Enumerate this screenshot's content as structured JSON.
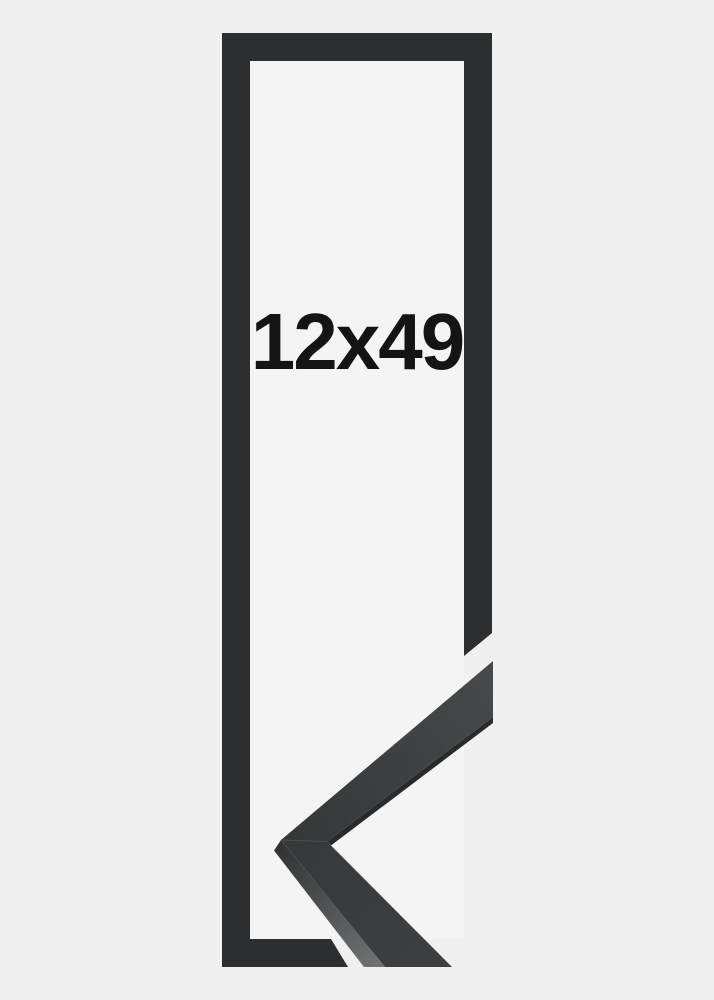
{
  "image": {
    "alt": "Tall narrow black picture frame shown as a flat outline with a 3D corner sample of the moulding profile at the lower right",
    "size_label": "12x49"
  },
  "colors": {
    "background": "#f0f0f1",
    "inner_background": "#f4f4f5",
    "frame": "#2c2e2f",
    "sample_face_start": "#343638",
    "sample_face_end": "#47494b",
    "sample_face_lower_start": "#36383a",
    "sample_face_lower_end": "#3c3e40",
    "sample_edge_dark": "#282a2c",
    "sample_side_start": "#303234",
    "sample_side_end": "#6f7173",
    "seam": "#4a4c4e",
    "text": "#141414"
  }
}
